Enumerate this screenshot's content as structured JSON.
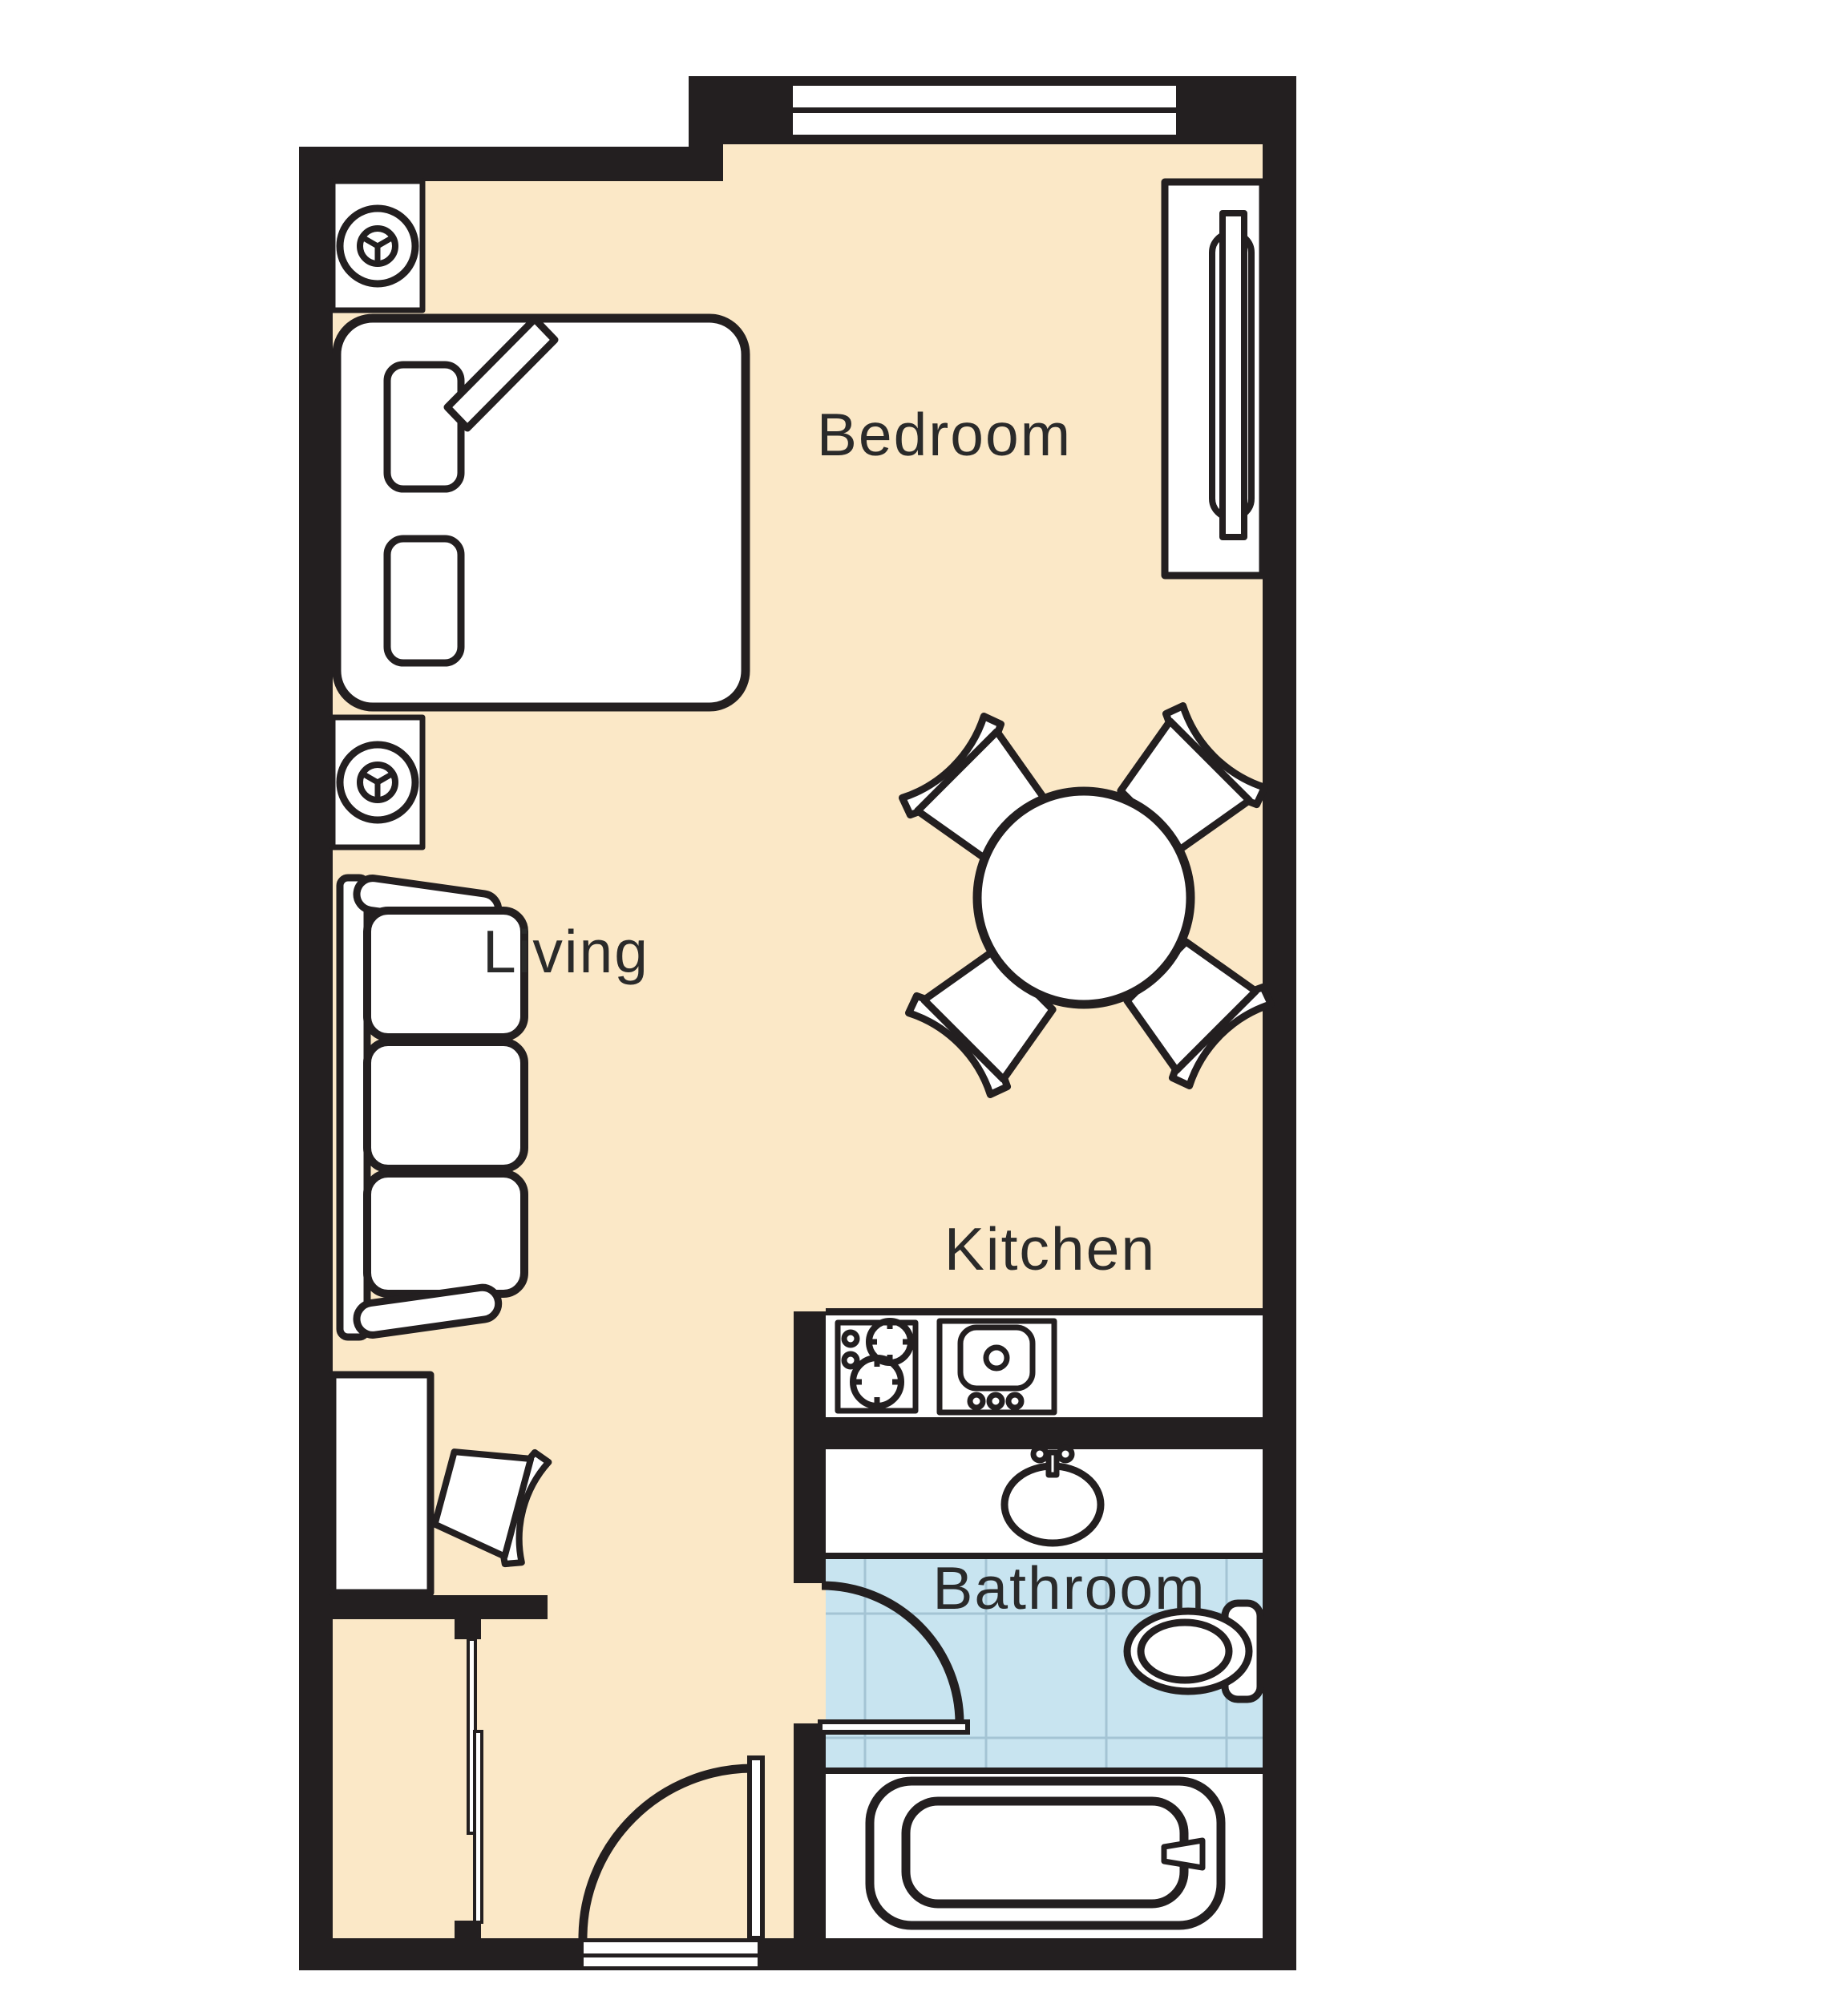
{
  "title": "Studio suite floor plan",
  "colors": {
    "wall": "#231F20",
    "ink": "#231F20",
    "floor": "#FBE8C7",
    "tile": "#C8E4F0",
    "tile_grid": "#A4C4D4",
    "label": "#2A2A2A",
    "paper": "#FFFFFF"
  },
  "rooms": {
    "bedroom": {
      "label": "Bedroom"
    },
    "living": {
      "label": "Living"
    },
    "kitchen": {
      "label": "Kitchen"
    },
    "bathroom": {
      "label": "Bathroom"
    }
  },
  "furniture": [
    "bed",
    "pillow",
    "blanket-fold",
    "nightstand-lamp",
    "tv-console",
    "tv",
    "dining-table",
    "dining-chair",
    "sofa",
    "desk",
    "desk-chair",
    "cooktop",
    "kitchen-sink",
    "vanity-sink",
    "toilet",
    "bathtub",
    "window",
    "entry-threshold",
    "entry-door",
    "bathroom-door",
    "closet-sliding-door"
  ]
}
